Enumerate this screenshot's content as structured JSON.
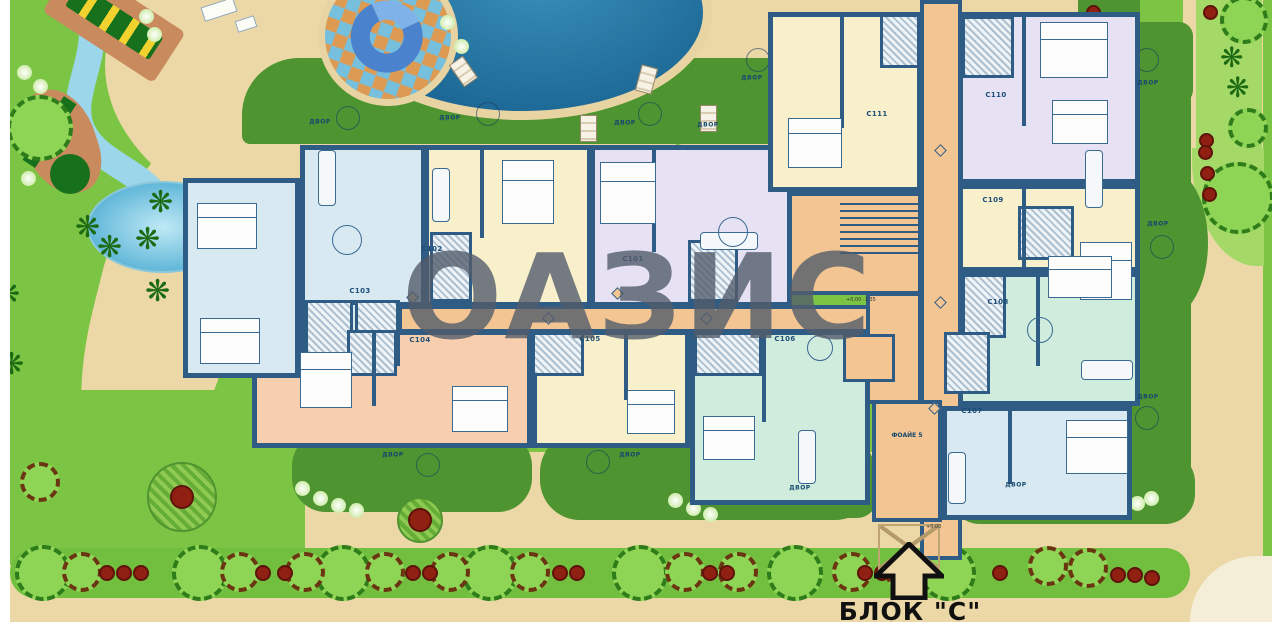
{
  "block_title": "БЛОК \"С\"",
  "watermark_text": "ОАЗИС",
  "foyer_label": "ФОАЙЕ 5",
  "yard_label_text": "ДВОР",
  "level_marks": [
    {
      "text": "+0.00 -1.35",
      "x": 846,
      "y": 297
    },
    {
      "text": "+0.00",
      "x": 926,
      "y": 524
    }
  ],
  "colors": {
    "grass": "#7cc544",
    "grass_light": "#a4d968",
    "sand": "#ebd8a6",
    "patio": "#4e9430",
    "band": "#72bf40",
    "pool": "#2a7fa9",
    "pool_deep": "#1c6795",
    "pool_rim": "#e7d4a2",
    "stream": "#9cd6ea",
    "wall": "#2e5c84",
    "corridor": "#f3c593",
    "apt_blue": "#d9e9f1",
    "apt_yellow": "#f7f0ca",
    "apt_lavender": "#e7e2f3",
    "apt_salmon": "#f7cfae",
    "apt_mint": "#cfecdc",
    "hatch_bg": "#eef3f7",
    "tree_light": "#8ed455",
    "tree_edge": "#2e7c1a",
    "brown_edge": "#6b3512",
    "bush_red": "#8f2012",
    "watermark": "rgba(82,92,108,0.8)",
    "text_blue": "#1d4e78",
    "pale": "#f4eed9"
  },
  "apartments": [
    {
      "code": "C103",
      "fill": "blue",
      "rect": [
        300,
        145,
        126,
        162
      ],
      "label": [
        360,
        291
      ]
    },
    {
      "code": "C102",
      "fill": "yellow",
      "rect": [
        424,
        145,
        168,
        162
      ],
      "label": [
        432,
        249
      ]
    },
    {
      "code": "C101",
      "fill": "lavender",
      "rect": [
        590,
        145,
        202,
        162
      ],
      "label": [
        633,
        259
      ]
    },
    {
      "code": "C111",
      "fill": "yellow",
      "rect": [
        768,
        12,
        154,
        180
      ],
      "label": [
        877,
        114
      ]
    },
    {
      "code": "C104",
      "fill": "salmon",
      "rect": [
        252,
        330,
        280,
        118
      ],
      "label": [
        420,
        340
      ]
    },
    {
      "code": "C105",
      "fill": "yellow",
      "rect": [
        532,
        330,
        158,
        118
      ],
      "label": [
        590,
        339
      ]
    },
    {
      "code": "C106",
      "fill": "mint",
      "rect": [
        690,
        330,
        180,
        175
      ],
      "label": [
        785,
        339
      ]
    },
    {
      "code": "C110",
      "fill": "lavender",
      "rect": [
        958,
        12,
        182,
        172
      ],
      "label": [
        996,
        95
      ]
    },
    {
      "code": "C109",
      "fill": "yellow",
      "rect": [
        958,
        184,
        182,
        88
      ],
      "label": [
        993,
        200
      ]
    },
    {
      "code": "C108",
      "fill": "mint",
      "rect": [
        958,
        272,
        182,
        134
      ],
      "label": [
        998,
        302
      ]
    },
    {
      "code": "C107",
      "fill": "blue",
      "rect": [
        942,
        406,
        190,
        114
      ],
      "label": [
        972,
        411
      ]
    },
    {
      "code": "",
      "fill": "blue",
      "rect": [
        183,
        178,
        117,
        200
      ],
      "label": null
    },
    {
      "code": "",
      "fill": "blue",
      "rect": [
        300,
        300,
        100,
        66
      ],
      "label": null
    }
  ],
  "building": {
    "corridor_h": [
      398,
      305,
      564,
      28
    ],
    "corridor_v": [
      920,
      0,
      42,
      560
    ],
    "stair_hall": [
      768,
      192,
      154,
      103
    ],
    "core": [
      866,
      292,
      56,
      112
    ],
    "foyer": [
      872,
      400,
      70,
      122
    ],
    "elevator": [
      843,
      334,
      52,
      48
    ],
    "canopy": [
      878,
      524,
      62,
      46
    ],
    "stairs": [
      840,
      198,
      78,
      58
    ]
  },
  "bath_hatches": [
    [
      305,
      300,
      48,
      62
    ],
    [
      355,
      300,
      44,
      62
    ],
    [
      430,
      232,
      42,
      70
    ],
    [
      688,
      240,
      50,
      62
    ],
    [
      347,
      330,
      50,
      46
    ],
    [
      532,
      332,
      52,
      44
    ],
    [
      694,
      332,
      68,
      44
    ],
    [
      962,
      16,
      52,
      62
    ],
    [
      880,
      14,
      40,
      54
    ],
    [
      1018,
      206,
      56,
      54
    ],
    [
      962,
      274,
      44,
      64
    ],
    [
      944,
      332,
      46,
      62
    ]
  ],
  "partitions": [
    [
      480,
      148,
      4,
      90
    ],
    [
      652,
      148,
      4,
      104
    ],
    [
      840,
      14,
      4,
      114
    ],
    [
      1022,
      14,
      4,
      112
    ],
    [
      1022,
      186,
      4,
      84
    ],
    [
      1036,
      274,
      4,
      92
    ],
    [
      1008,
      408,
      4,
      76
    ],
    [
      372,
      332,
      4,
      74
    ],
    [
      624,
      332,
      4,
      68
    ],
    [
      762,
      332,
      4,
      90
    ],
    [
      300,
      182,
      4,
      122
    ]
  ],
  "furniture": {
    "beds": [
      [
        197,
        203,
        60,
        46
      ],
      [
        200,
        318,
        60,
        46
      ],
      [
        300,
        352,
        52,
        56
      ],
      [
        452,
        386,
        56,
        46
      ],
      [
        502,
        160,
        52,
        64
      ],
      [
        600,
        162,
        56,
        62
      ],
      [
        627,
        390,
        48,
        44
      ],
      [
        703,
        416,
        52,
        44
      ],
      [
        788,
        118,
        54,
        50
      ],
      [
        1040,
        22,
        68,
        56
      ],
      [
        1052,
        100,
        56,
        44
      ],
      [
        1080,
        242,
        52,
        58
      ],
      [
        1048,
        256,
        64,
        42
      ],
      [
        1066,
        420,
        62,
        54
      ]
    ],
    "sofas": [
      [
        318,
        150,
        18,
        56
      ],
      [
        432,
        168,
        18,
        54
      ],
      [
        700,
        232,
        58,
        18
      ],
      [
        948,
        452,
        18,
        52
      ],
      [
        798,
        430,
        18,
        54
      ],
      [
        1085,
        150,
        18,
        58
      ],
      [
        1081,
        360,
        52,
        20
      ]
    ],
    "tables": [
      [
        347,
        240,
        30
      ],
      [
        733,
        232,
        30
      ],
      [
        1040,
        330,
        26
      ],
      [
        820,
        348,
        26
      ]
    ]
  },
  "diamonds": [
    [
      412,
      297
    ],
    [
      548,
      318
    ],
    [
      617,
      293
    ],
    [
      706,
      318
    ],
    [
      940,
      150
    ],
    [
      940,
      302
    ],
    [
      934,
      408
    ]
  ],
  "yard_labels": [
    [
      320,
      122
    ],
    [
      450,
      118
    ],
    [
      625,
      123
    ],
    [
      708,
      125
    ],
    [
      752,
      78
    ],
    [
      1148,
      83
    ],
    [
      1158,
      224
    ],
    [
      1148,
      397
    ],
    [
      393,
      455
    ],
    [
      630,
      455
    ],
    [
      800,
      488
    ],
    [
      1016,
      485
    ]
  ],
  "patio_tables": [
    [
      348,
      118
    ],
    [
      488,
      114
    ],
    [
      650,
      114
    ],
    [
      758,
      60
    ],
    [
      1147,
      60
    ],
    [
      1162,
      247
    ],
    [
      1147,
      418
    ],
    [
      428,
      465
    ],
    [
      598,
      462
    ],
    [
      832,
      490
    ],
    [
      992,
      488
    ]
  ],
  "loungers": [
    [
      455,
      58,
      -35
    ],
    [
      638,
      66,
      15
    ],
    [
      580,
      115,
      0
    ],
    [
      700,
      105,
      0
    ]
  ],
  "landscape": {
    "sand": [
      [
        105,
        -120,
        600,
        370,
        "50%",
        0
      ],
      [
        560,
        -140,
        430,
        300,
        "50%",
        0
      ],
      [
        95,
        130,
        140,
        360,
        "45%",
        14
      ],
      [
        10,
        452,
        1252,
        172,
        "0",
        0
      ],
      [
        1183,
        0,
        80,
        624,
        "0",
        0
      ],
      [
        660,
        -40,
        300,
        110,
        "40%",
        0
      ],
      [
        955,
        0,
        185,
        42,
        "0 0 20px 0",
        0
      ]
    ],
    "grass_patches": [
      [
        0,
        390,
        305,
        175,
        "0 70px 0 0"
      ]
    ],
    "light_strips": [
      [
        1196,
        0,
        66,
        150,
        "0"
      ],
      [
        1192,
        148,
        72,
        118,
        "0 0 0 90%"
      ]
    ],
    "patios": [
      [
        242,
        58,
        700,
        86,
        "70px 90px 16px 10px"
      ],
      [
        1131,
        52,
        60,
        452,
        "24px"
      ],
      [
        1126,
        168,
        82,
        150,
        "50%"
      ],
      [
        1078,
        0,
        62,
        32,
        "0 0 12px 12px"
      ],
      [
        1127,
        22,
        66,
        82,
        "14px"
      ]
    ],
    "yards": [
      [
        292,
        432,
        240,
        80,
        "34px"
      ],
      [
        540,
        432,
        335,
        88,
        "40px"
      ],
      [
        815,
        468,
        62,
        50,
        "20px"
      ],
      [
        950,
        452,
        245,
        72,
        "30px"
      ]
    ],
    "bottom_band": [
      10,
      548,
      1180,
      50,
      "26px"
    ],
    "pale_corner": [
      1190,
      556,
      90,
      66,
      "80px 0 0 0"
    ],
    "trees": [
      [
        "big",
        43,
        573,
        56
      ],
      [
        "big",
        200,
        573,
        56
      ],
      [
        "big",
        343,
        573,
        56
      ],
      [
        "big",
        490,
        573,
        56
      ],
      [
        "big",
        640,
        573,
        56
      ],
      [
        "big",
        795,
        573,
        56
      ],
      [
        "big",
        948,
        573,
        56
      ],
      [
        "brown",
        82,
        572,
        40
      ],
      [
        "brown",
        240,
        572,
        40
      ],
      [
        "brown",
        305,
        572,
        40
      ],
      [
        "brown",
        385,
        572,
        40
      ],
      [
        "brown",
        450,
        572,
        40
      ],
      [
        "brown",
        530,
        572,
        40
      ],
      [
        "brown",
        685,
        572,
        40
      ],
      [
        "brown",
        738,
        572,
        40
      ],
      [
        "brown",
        852,
        572,
        40
      ],
      [
        "brown",
        905,
        572,
        40
      ],
      [
        "brown",
        1048,
        566,
        40
      ],
      [
        "brown",
        1088,
        568,
        40
      ],
      [
        "bush",
        107,
        573,
        16
      ],
      [
        "bush",
        124,
        573,
        16
      ],
      [
        "bush",
        141,
        573,
        16
      ],
      [
        "bush",
        263,
        573,
        16
      ],
      [
        "bush",
        285,
        573,
        16
      ],
      [
        "bush",
        413,
        573,
        16
      ],
      [
        "bush",
        430,
        573,
        16
      ],
      [
        "bush",
        560,
        573,
        16
      ],
      [
        "bush",
        577,
        573,
        16
      ],
      [
        "bush",
        710,
        573,
        16
      ],
      [
        "bush",
        727,
        573,
        16
      ],
      [
        "bush",
        865,
        573,
        16
      ],
      [
        "bush",
        882,
        573,
        16
      ],
      [
        "bush",
        1000,
        573,
        16
      ],
      [
        "bush",
        1118,
        575,
        16
      ],
      [
        "bush",
        1135,
        575,
        16
      ],
      [
        "bush",
        1152,
        578,
        16
      ],
      [
        "big",
        40,
        128,
        66
      ],
      [
        "brown",
        40,
        482,
        40
      ],
      [
        "hatched",
        182,
        497,
        70
      ],
      [
        "hatched",
        420,
        520,
        46
      ],
      [
        "big",
        1244,
        20,
        48
      ],
      [
        "big",
        1248,
        128,
        40
      ],
      [
        "big",
        1238,
        198,
        72
      ],
      [
        "bush",
        1210,
        12,
        15
      ],
      [
        "bush",
        1093,
        12,
        15
      ],
      [
        "bush",
        1206,
        140,
        15
      ],
      [
        "bush",
        1205,
        152,
        15
      ],
      [
        "bush",
        1207,
        173,
        15
      ],
      [
        "bush",
        1209,
        194,
        15
      ],
      [
        "palm",
        90,
        228,
        30
      ],
      [
        "palm",
        112,
        248,
        30
      ],
      [
        "palm",
        150,
        240,
        30
      ],
      [
        "palm",
        163,
        203,
        30
      ],
      [
        "palm",
        470,
        198,
        30
      ],
      [
        "palm",
        160,
        292,
        30
      ],
      [
        "palm",
        10,
        295,
        30
      ],
      [
        "palm",
        14,
        365,
        30
      ],
      [
        "palm",
        1234,
        58,
        28
      ],
      [
        "palm",
        1240,
        88,
        28
      ],
      [
        "glow",
        24,
        72,
        15
      ],
      [
        "glow",
        40,
        86,
        15
      ],
      [
        "glow",
        146,
        16,
        15
      ],
      [
        "glow",
        154,
        34,
        15
      ],
      [
        "glow",
        28,
        178,
        15
      ],
      [
        "glow",
        447,
        22,
        15
      ],
      [
        "glow",
        461,
        46,
        15
      ],
      [
        "glow",
        302,
        488,
        15
      ],
      [
        "glow",
        320,
        498,
        15
      ],
      [
        "glow",
        338,
        505,
        15
      ],
      [
        "glow",
        356,
        510,
        15
      ],
      [
        "glow",
        675,
        500,
        15
      ],
      [
        "glow",
        693,
        508,
        15
      ],
      [
        "glow",
        710,
        514,
        15
      ],
      [
        "glow",
        1123,
        508,
        15
      ],
      [
        "glow",
        1137,
        503,
        15
      ],
      [
        "glow",
        1151,
        498,
        15
      ],
      [
        "glow",
        246,
        258,
        12
      ],
      [
        "glow",
        240,
        272,
        12
      ]
    ]
  }
}
